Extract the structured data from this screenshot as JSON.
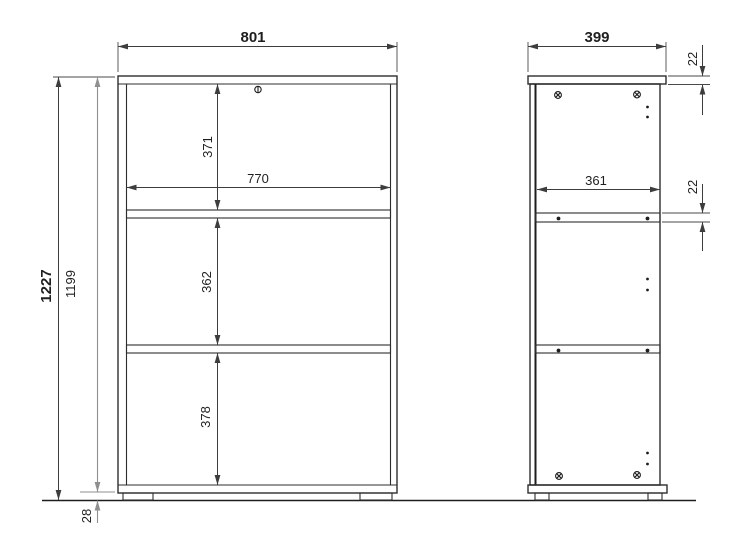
{
  "drawing": {
    "type": "furniture-technical-drawing",
    "units": "mm",
    "front_view": {
      "overall_width": "801",
      "overall_height": "1227",
      "carcass_height": "1199",
      "inner_width": "770",
      "top_compartment_height": "371",
      "middle_compartment_height": "362",
      "bottom_compartment_height": "378",
      "plinth_height": "28"
    },
    "side_view": {
      "overall_depth": "399",
      "inner_depth": "361",
      "top_panel_thickness": "22",
      "shelf_thickness": "22"
    },
    "colors": {
      "object_line": "#2d2d2d",
      "dimension_line": "#3d3d3d",
      "light_dimension_line": "#8f8f8f",
      "background": "#ffffff"
    }
  }
}
